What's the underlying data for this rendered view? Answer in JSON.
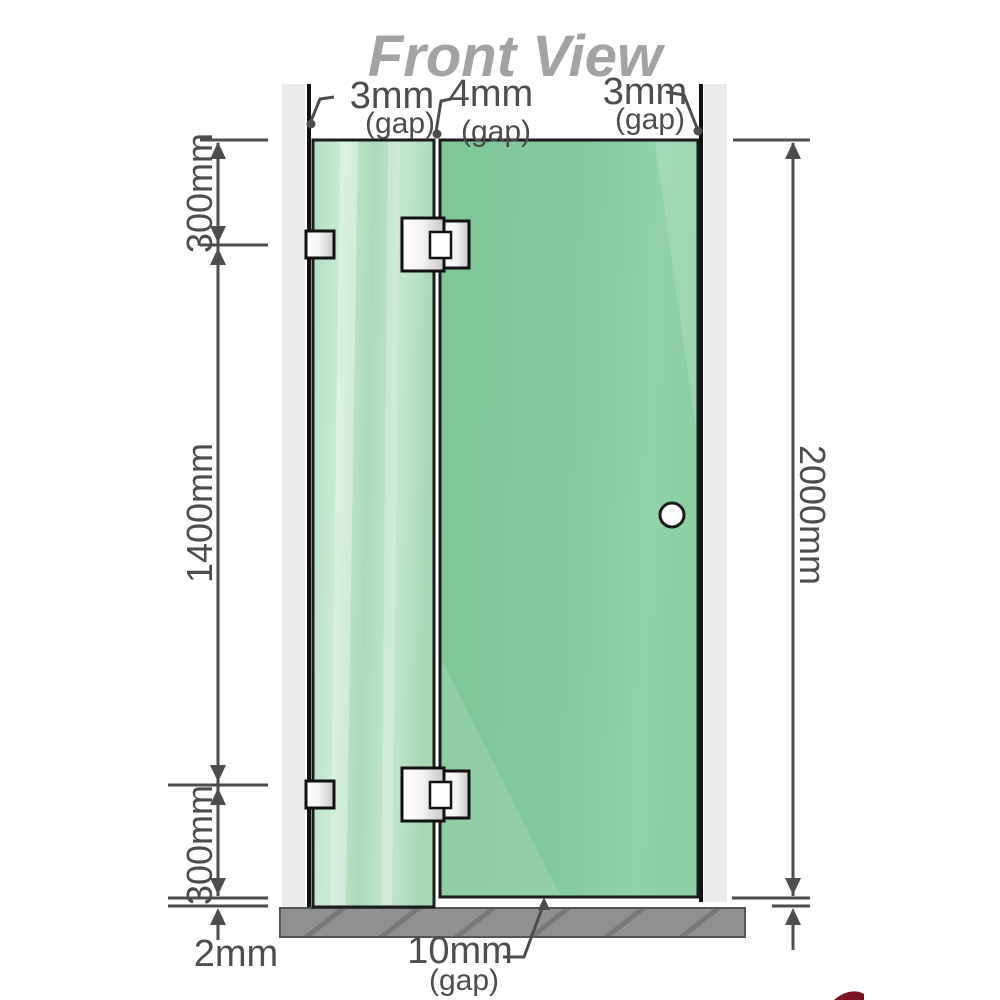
{
  "title": "Front View",
  "labels": {
    "gap_top_left": {
      "value": "3mm",
      "note": "(gap)"
    },
    "gap_top_middle": {
      "value": "4mm",
      "note": "(gap)"
    },
    "gap_top_right": {
      "value": "3mm",
      "note": "(gap)"
    },
    "gap_bottom": {
      "value": "10mm",
      "note": "(gap)"
    },
    "dim_top_section": "300mm",
    "dim_middle_section": "1400mm",
    "dim_bottom_section": "300mm",
    "dim_total_height": "2000mm",
    "dim_floor_clearance": "2mm"
  },
  "colors": {
    "glass_left": "#aedcbc",
    "glass_right": "#84ca9d",
    "wall": "#eaeaea",
    "wall_edge": "#111111",
    "floor": "#8e9091",
    "dimension": "#4d4d4d",
    "title": "#a3a3a3",
    "hardware": "#e8e8e8",
    "watermark_red": "#7a1220"
  }
}
